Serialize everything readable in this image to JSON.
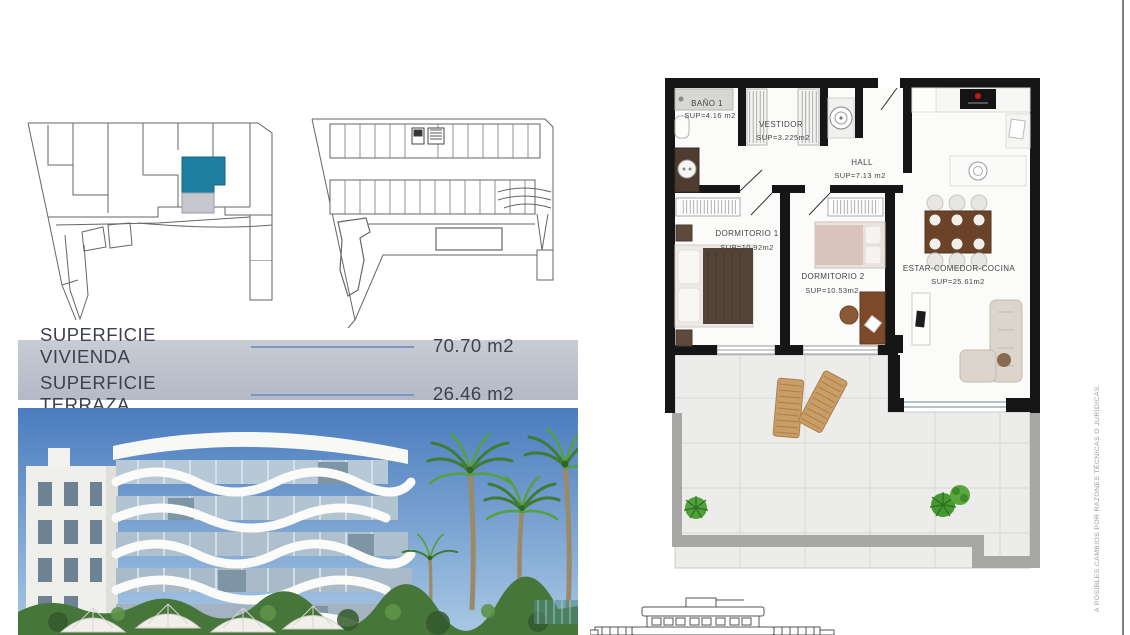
{
  "surface_panel": {
    "rows": [
      {
        "label": "SUPERFICIE VIVIENDA",
        "value": "70.70 m2"
      },
      {
        "label": "SUPERFICIE TERRAZA",
        "value": "26.46 m2"
      }
    ]
  },
  "floor_plan": {
    "rooms": [
      {
        "id": "bano1",
        "name": "BAÑO 1",
        "sup": "SUP=4.16 m2"
      },
      {
        "id": "vestidor",
        "name": "VESTIDOR",
        "sup": "SUP=3.225m2"
      },
      {
        "id": "hall",
        "name": "HALL",
        "sup": "SUP=7.13 m2"
      },
      {
        "id": "dormitorio1",
        "name": "DORMITORIO 1",
        "sup": "SUP=10.92m2"
      },
      {
        "id": "dormitorio2",
        "name": "DORMITORIO 2",
        "sup": "SUP=10.53m2"
      },
      {
        "id": "estar",
        "name": "ESTAR-COMEDOR-COCINA",
        "sup": "SUP=25.61m2"
      }
    ]
  },
  "disclaimer": {
    "text": "A POSIBLES CAMBIOS POR RAZONES TÉCNICAS O JURÍDICAS."
  },
  "colors": {
    "unit_highlight": "#1f7fa3",
    "unit_secondary": "#c5c7cd",
    "banner_bg": "#b9c0cb",
    "banner_rule": "#7e96c3",
    "banner_text": "#3d414d",
    "plan_wall": "#161616",
    "terrace_rail": "#a7a7a5",
    "lounger_wood": "#c99d66",
    "plant_green": "#4fa13a",
    "sky_blue": "#4a7cbe"
  }
}
